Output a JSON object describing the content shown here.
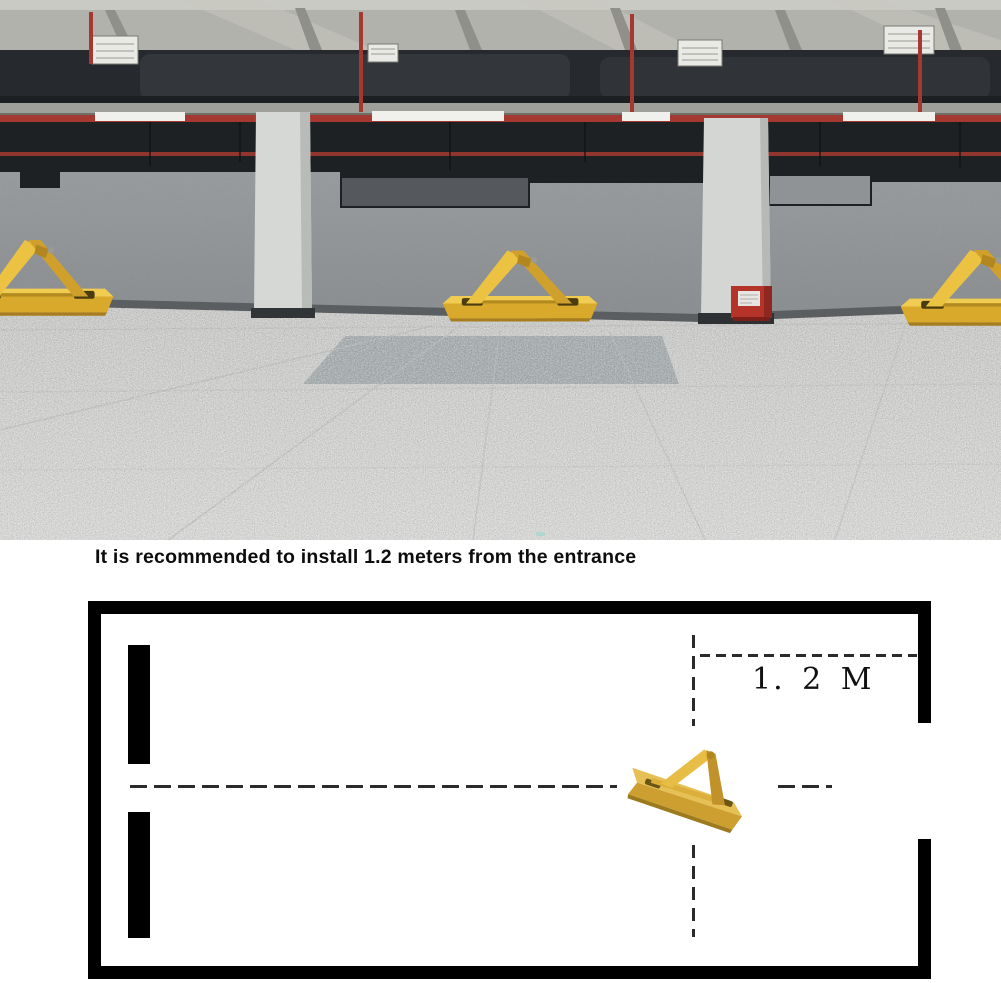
{
  "caption": {
    "text": "It is recommended to install 1.2 meters from the entrance"
  },
  "diagram": {
    "distance_label": "1. 2 M",
    "wall_color": "#000000",
    "dash_color": "#2b2b2b",
    "elements": [
      "parking-bay-outline",
      "entrance-gap-right-wall",
      "center-dashed-line",
      "vertical-dashed-line",
      "distance-dashed-line",
      "parking-lock-product-photo"
    ]
  },
  "photo": {
    "elements": [
      "parking-garage-interior",
      "ceiling-ducts",
      "red-fire-pipes",
      "fluorescent-lights",
      "air-vents",
      "concrete-column-left",
      "concrete-column-right",
      "red-fire-box",
      "terrazzo-floor",
      "floor-mat",
      "yellow-parking-lock-left",
      "yellow-parking-lock-center",
      "yellow-parking-lock-right"
    ],
    "colors": {
      "barrier_yellow": "#e8bc2e",
      "barrier_gold": "#d2a02f",
      "wall_gray": "#97999c",
      "floor_gray": "#d8d9d7",
      "pipe_red": "#a53931",
      "firebox_red": "#b5342a",
      "ceiling_dark": "#26292d"
    }
  }
}
